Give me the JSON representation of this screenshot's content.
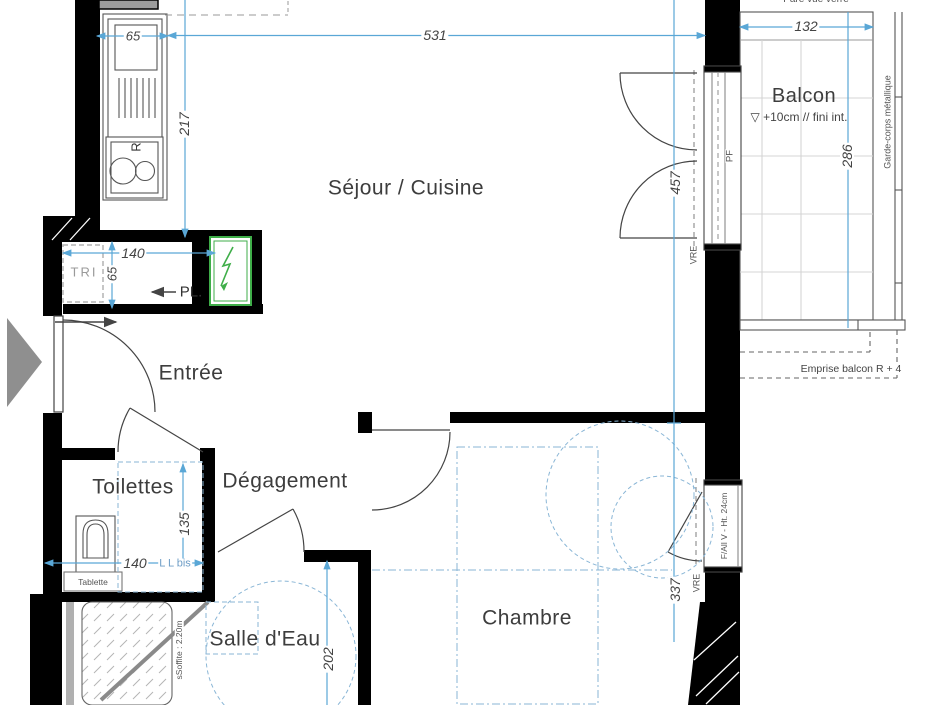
{
  "rooms": {
    "sejour_cuisine": "Séjour / Cuisine",
    "balcon": "Balcon",
    "entree": "Entrée",
    "toilettes": "Toilettes",
    "degagement": "Dégagement",
    "salle_eau": "Salle d'Eau",
    "chambre": "Chambre"
  },
  "dimensions": {
    "d65_kitchen": "65",
    "d531": "531",
    "d217": "217",
    "d140_pl": "140",
    "d65_pl": "65",
    "d457": "457",
    "d337": "337",
    "d132": "132",
    "d286": "286",
    "d135": "135",
    "d140_toilettes": "140",
    "d202": "202"
  },
  "labels": {
    "level_note": "▽ +10cm // fini int.",
    "pare_vue": "Pare vue verre",
    "garde_corps": "Garde-corps métallique",
    "emprise_balcon": "Emprise balcon R + 4",
    "pf_window": "PF",
    "vre_sejour": "VRE",
    "vre_chambre": "VRE",
    "window_sill": "F/All V - Ht. 24cm",
    "tri": "TRI",
    "pl_closet": "PL.",
    "appliance_r": "R",
    "ll_bis": "L L bis",
    "tablette": "Tablette",
    "soffit": "sSoffite : 2.20m"
  },
  "colors": {
    "wall": "#000000",
    "dim_blue": "#5aa7d6",
    "dash_blue": "#8ab6d6",
    "panel_green": "#3fae49",
    "triangle_gray": "#8f8f8f"
  }
}
